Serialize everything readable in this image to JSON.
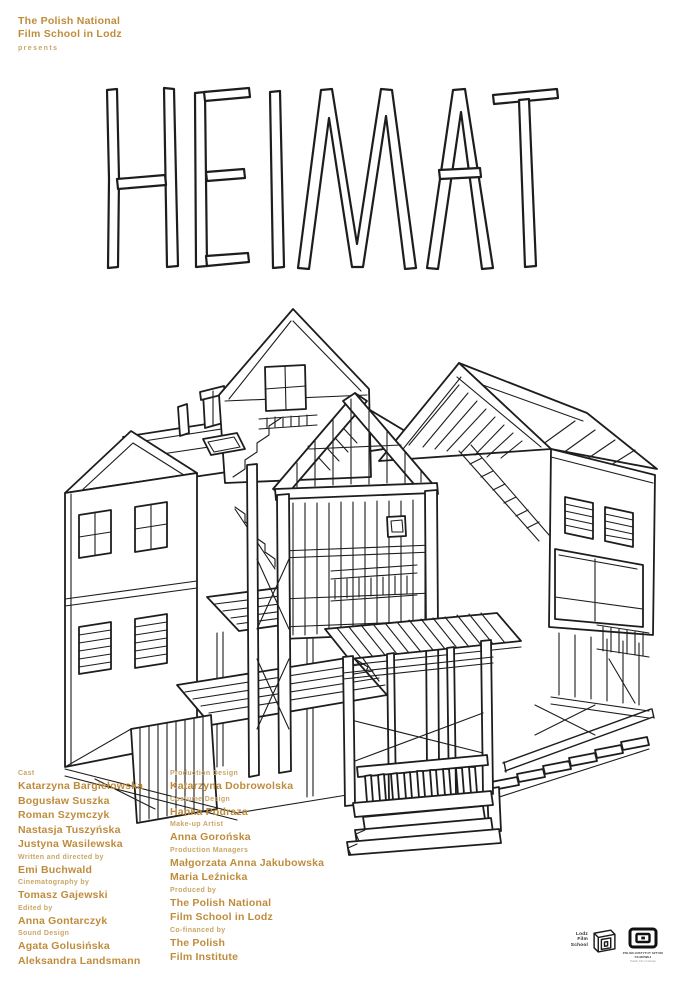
{
  "header": {
    "school_line1": "The Polish National",
    "school_line2": "Film School in Lodz",
    "presents": "presents"
  },
  "title": {
    "text": "HEIMAT"
  },
  "illustration": {
    "name": "hand-drawn-cutaway-house-drawing"
  },
  "credits": {
    "left": [
      {
        "label": "Cast",
        "names": [
          "Katarzyna Bargiełowska",
          "Bogusław Suszka",
          "Roman Szymczyk",
          "Nastasja Tuszyńska",
          "Justyna Wasilewska"
        ]
      },
      {
        "label": "Written and directed by",
        "names": [
          "Emi Buchwald"
        ]
      },
      {
        "label": "Cinematography by",
        "names": [
          "Tomasz Gajewski"
        ]
      },
      {
        "label": "Edited by",
        "names": [
          "Anna Gontarczyk"
        ]
      },
      {
        "label": "Sound Design",
        "names": [
          "Agata Golusińska",
          "Aleksandra Landsmann"
        ]
      }
    ],
    "right": [
      {
        "label": "Production Design",
        "names": [
          "Katarzyna Dobrowolska"
        ]
      },
      {
        "label": "Costume Design",
        "names": [
          "Hanka Podraza"
        ]
      },
      {
        "label": "Make-up Artist",
        "names": [
          "Anna Gorońska"
        ]
      },
      {
        "label": "Production Managers",
        "names": [
          "Małgorzata Anna Jakubowska",
          "Maria Leźnicka"
        ]
      },
      {
        "label": "Produced by",
        "names": [
          "The Polish National",
          "Film School in Lodz"
        ]
      },
      {
        "label": "Co-financed by",
        "names": [
          "The Polish",
          "Film Institute"
        ]
      }
    ]
  },
  "logos": {
    "lodz_film_school": {
      "line1": "Lodz",
      "line2": "Film",
      "line3": "School"
    },
    "pisf": {
      "caption_line1": "POLSKI INSTYTUT SZTUKI FILMOWEJ",
      "caption_line2": "Polish Film Institute"
    }
  },
  "colors": {
    "accent_names": "#bf8c3c",
    "accent_labels": "#c9a668",
    "ink": "#1d1d1d",
    "paper": "#ffffff"
  }
}
